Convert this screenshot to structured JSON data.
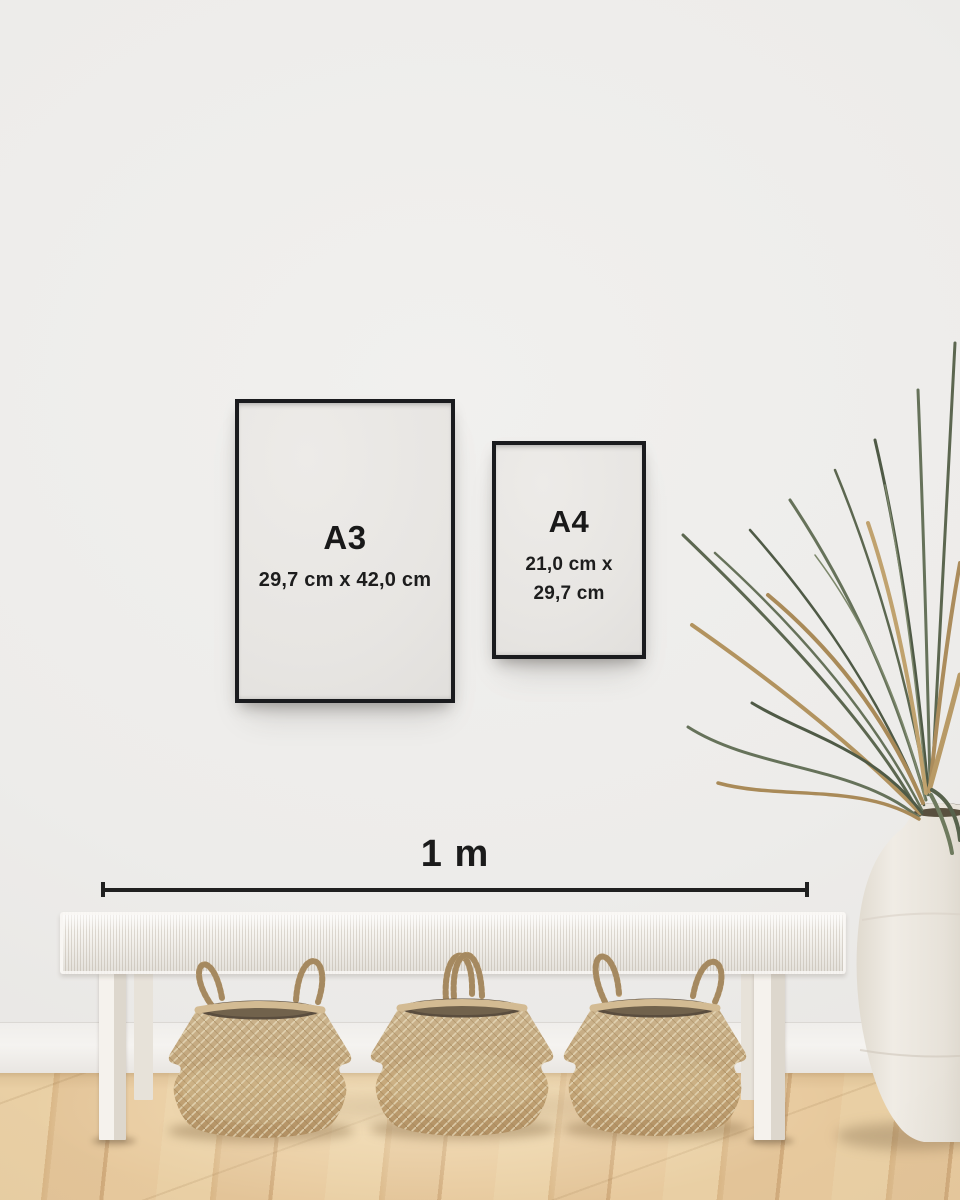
{
  "frames": {
    "a3": {
      "label": "A3",
      "dimensions": "29,7 cm x 42,0 cm"
    },
    "a4": {
      "label": "A4",
      "dimensions_line1": "21,0 cm x",
      "dimensions_line2": "29,7 cm"
    }
  },
  "scale": {
    "label": "1 m"
  },
  "colors": {
    "wall": "#edecea",
    "frame_black": "#1a1b1e",
    "paper": "#e7e5e2",
    "text": "#191919",
    "measure_line": "#202020",
    "floor_wood": "#deba8c",
    "bench_white": "#f3f1ed",
    "basket_tan": "#c2a77f",
    "basket_dark_interior": "#5a4d3e",
    "plant_green": "#5c6750",
    "plant_dried": "#b2935f",
    "vase_white": "#eae6df"
  }
}
